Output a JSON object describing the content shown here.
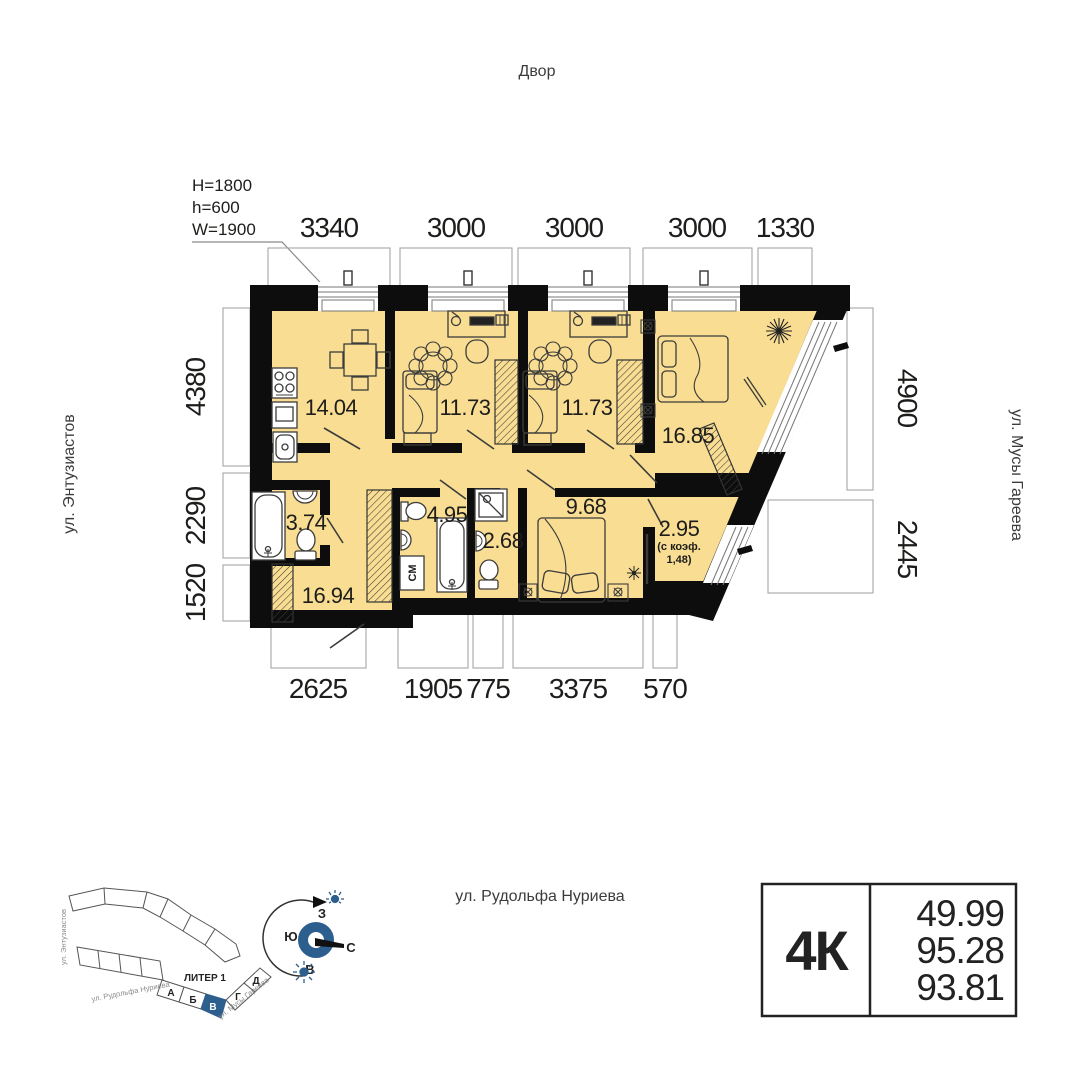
{
  "labels": {
    "courtyard": "Двор",
    "street_left": "ул. Энтузиастов",
    "street_right": "ул. Мусы Гареева",
    "street_bottom": "ул. Рудольфа Нуриева"
  },
  "window_spec": {
    "H": "H=1800",
    "h": "h=600",
    "W": "W=1900"
  },
  "dimensions": {
    "top": [
      "3340",
      "3000",
      "3000",
      "3000",
      "1330"
    ],
    "left": [
      "4380",
      "2290",
      "1520"
    ],
    "right": [
      "4900",
      "2445"
    ],
    "bottom": [
      "2625",
      "1905",
      "775",
      "3375",
      "570"
    ]
  },
  "rooms": {
    "kitchen": "14.04",
    "bedroom1": "11.73",
    "bedroom2": "11.73",
    "master_bedroom": "16.85",
    "bathroom": "3.74",
    "hall": "16.94",
    "bathroom2": "4.95",
    "wc": "2.68",
    "bedroom3": "9.68",
    "loggia": "2.95",
    "loggia_note_line1": "(с коэф.",
    "loggia_note_line2": "1,48)",
    "washing_machine": "СМ"
  },
  "site_plan": {
    "liter_label": "ЛИТЕР 1",
    "sections": [
      "А",
      "Б",
      "В",
      "Г",
      "Д"
    ],
    "highlighted_section": "В",
    "streets": {
      "left": "ул. Энтузиастов",
      "bottom": "ул. Рудольфа Нуриева",
      "right": "ул. Мусы Гареева"
    }
  },
  "compass": {
    "west": "З",
    "south": "Ю",
    "north": "С",
    "east": "В"
  },
  "apartment_card": {
    "type": "4К",
    "areas": [
      "49.99",
      "95.28",
      "93.81"
    ]
  },
  "colors": {
    "accent_blue": "#2D5F8E",
    "room_fill": "#F8DD92",
    "wall": "#0d0d0d",
    "extent_line": "#a6a6a6"
  }
}
